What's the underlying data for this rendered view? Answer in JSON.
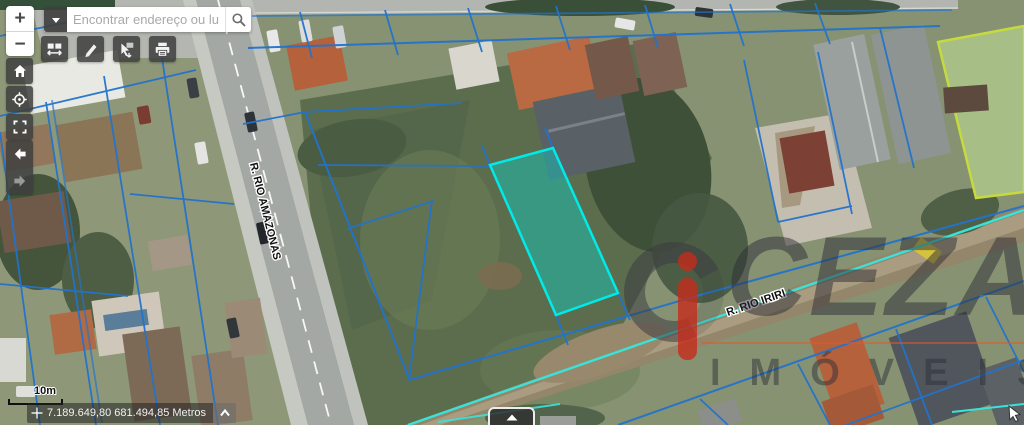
{
  "zoom_control": {
    "zoom_in_label": "+",
    "zoom_out_label": "−"
  },
  "search": {
    "placeholder": "Encontrar endereço ou lugar"
  },
  "toolbar": {
    "buttons": [
      {
        "name": "basemap-swipe",
        "icon": "swipe-icon"
      },
      {
        "name": "draw-measure",
        "icon": "pencil-icon"
      },
      {
        "name": "select-features",
        "icon": "select-cursor-icon"
      },
      {
        "name": "print",
        "icon": "printer-icon"
      }
    ]
  },
  "nav_buttons": [
    {
      "name": "home",
      "icon": "home-icon"
    },
    {
      "name": "locate",
      "icon": "locate-icon"
    },
    {
      "name": "fullscreen",
      "icon": "expand-icon"
    },
    {
      "name": "previous-extent",
      "icon": "arrow-left-icon",
      "enabled": true
    },
    {
      "name": "next-extent",
      "icon": "arrow-right-icon",
      "enabled": false
    }
  ],
  "map": {
    "street_labels": [
      {
        "text": "R. RIO AMAZONAS"
      },
      {
        "text": "R. RIO IRIRI"
      }
    ],
    "highlighted_parcel": {
      "stroke": "#00eaea",
      "fill": "rgba(0,224,213,0.38)"
    },
    "parcel_line_color": "#2273cc",
    "block_boundary_color": "#c6da3e",
    "road_centerline_color": "#3ae2d8"
  },
  "scale_bar": {
    "label": "10m"
  },
  "status_bar": {
    "coordinates": "7.189.649,80 681.494,85 Metros"
  },
  "watermark": {
    "brand": "CEZAR",
    "subtitle": "IMÓVEIS",
    "accent_color": "#c62c1c"
  },
  "bottom_tab": {
    "icon": "chevron-up"
  }
}
